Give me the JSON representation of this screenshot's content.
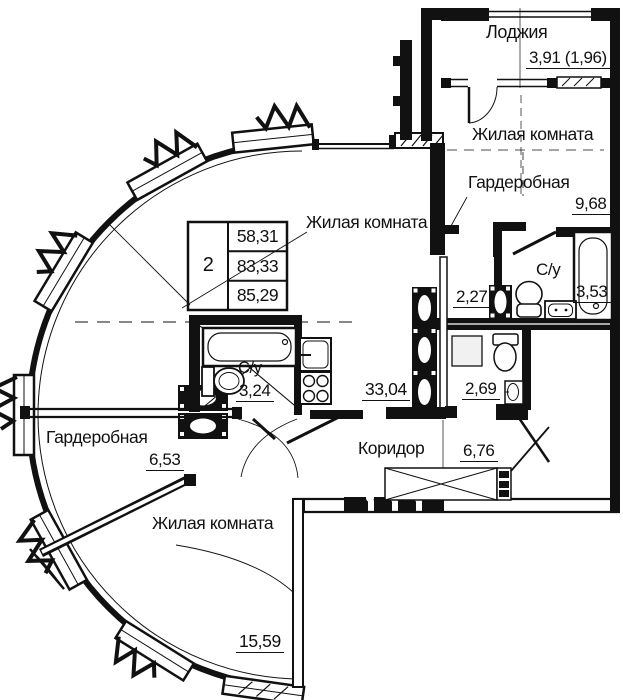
{
  "colors": {
    "ink": "#111111",
    "paper": "#ffffff"
  },
  "area_table": {
    "apartment_number": "2",
    "living_area": "58,31",
    "total_area": "83,33",
    "total_area_with_loggia": "85,29"
  },
  "rooms": {
    "loggia": {
      "name": "Лоджия",
      "area": "3,91 (1,96)"
    },
    "living_top": {
      "name": "Жилая комната",
      "area": "9,68"
    },
    "wardrobe_top": {
      "name": "Гардеробная",
      "area": "2,27"
    },
    "bath_top": {
      "name": "С/у",
      "area": "3,53"
    },
    "laundry": {
      "area": "2,69"
    },
    "living_main": {
      "name": "Жилая комната",
      "area": "33,04"
    },
    "bath_main": {
      "name": "С/у",
      "area": "3,24"
    },
    "corridor": {
      "name": "Коридор",
      "area": "6,76"
    },
    "wardrobe_left": {
      "name": "Гардеробная",
      "area": "6,53"
    },
    "living_bottom": {
      "name": "Жилая комната",
      "area": "15,59"
    }
  }
}
